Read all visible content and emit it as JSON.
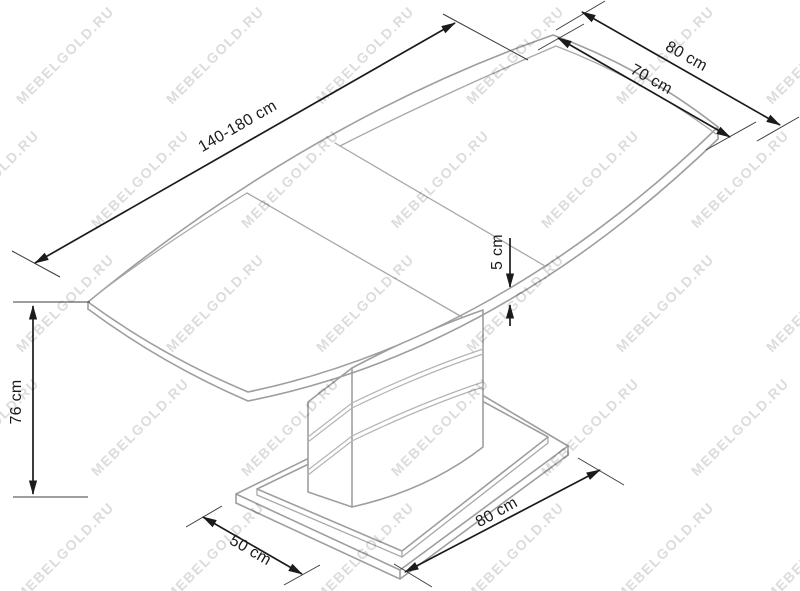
{
  "diagram": {
    "subject": "Extendable pedestal dining table - dimension drawing",
    "labels": {
      "length_range": "140-180 cm",
      "top_width_outer": "80 cm",
      "top_width_inner": "70 cm",
      "top_thickness": "5 cm",
      "table_height": "76 cm",
      "base_depth": "50 cm",
      "base_length": "80 cm"
    },
    "watermark": {
      "text": "MEBELGOLD.RU",
      "color": "#dcdcdc"
    },
    "colors": {
      "ink": "#1b1b1b",
      "furniture_line": "#9e9e9e",
      "background": "#ffffff"
    }
  }
}
